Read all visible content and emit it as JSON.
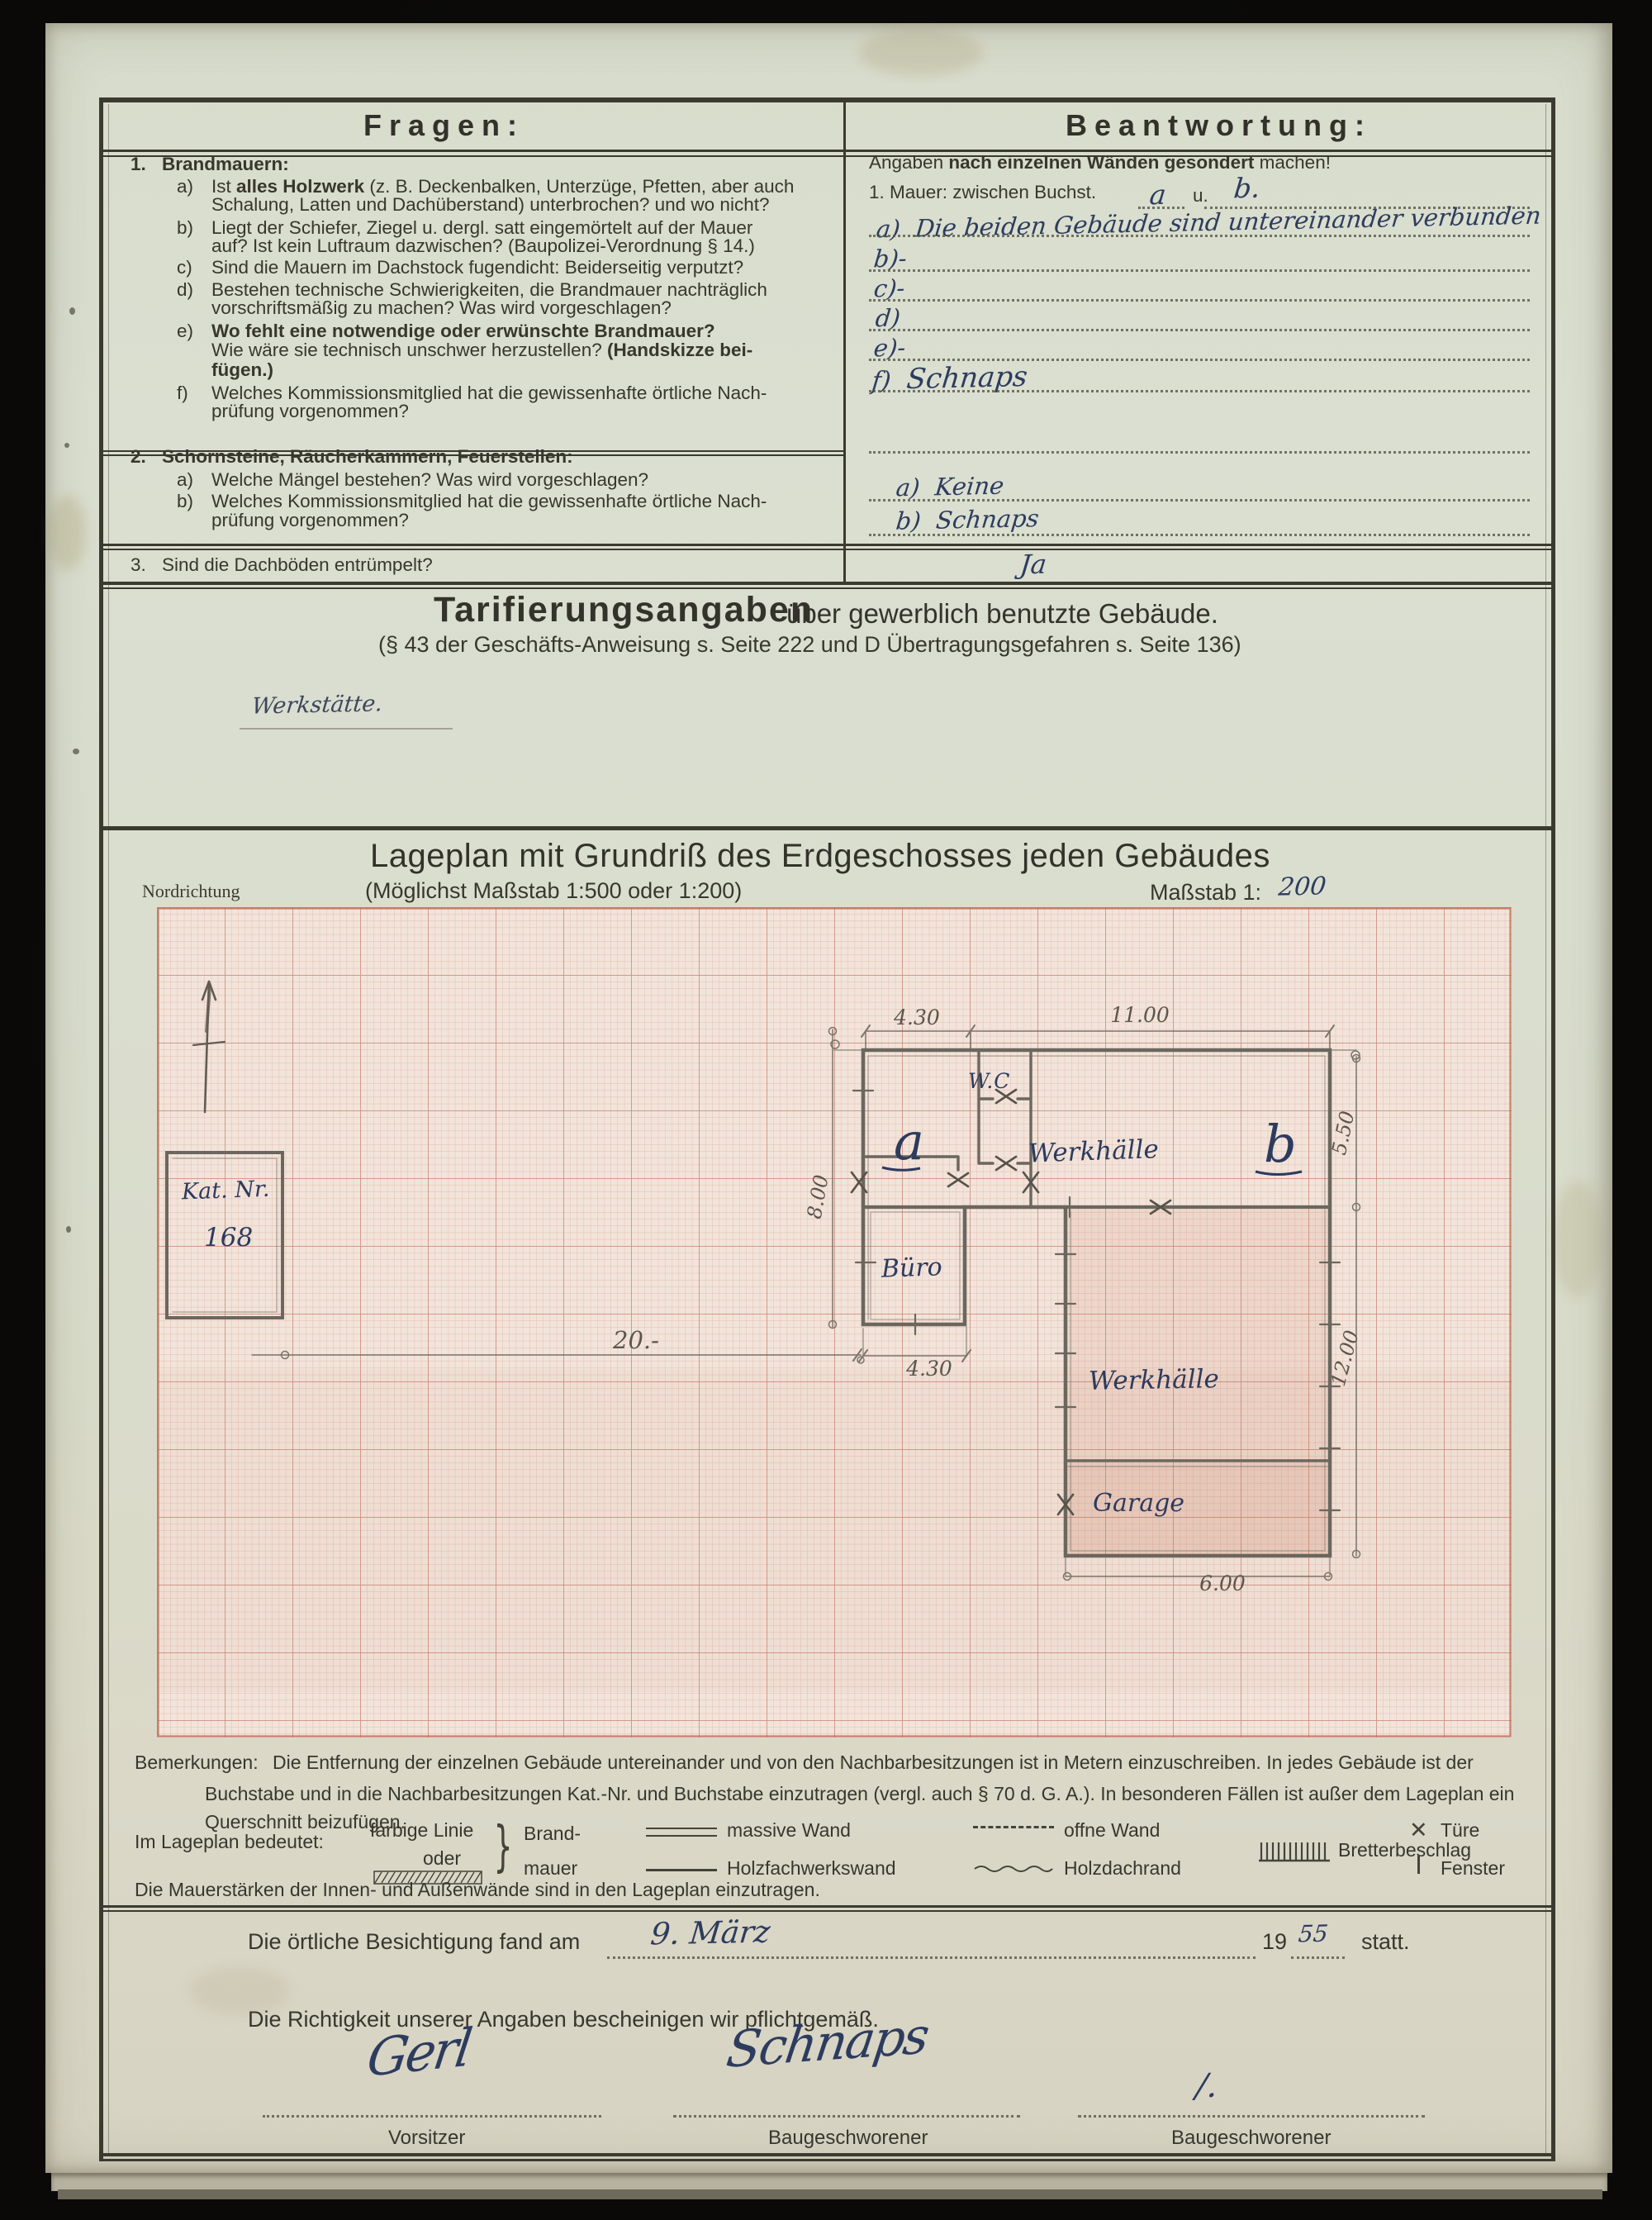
{
  "header": {
    "left": "Fragen:",
    "right": "Beantwortung:"
  },
  "q1": {
    "no": "1.",
    "title": "Brandmauern:",
    "a_letter": "a)",
    "a1_pre": "Ist ",
    "a1_b": "alles Holzwerk ",
    "a1_post": "(z. B. Deckenbalken, Unterzüge, Pfetten, aber auch",
    "a2": "Schalung, Latten und Dachüberstand) unterbrochen? und wo nicht?",
    "b_letter": "b)",
    "b1": "Liegt der Schiefer, Ziegel u. dergl. satt eingemörtelt auf der Mauer",
    "b2": "auf? Ist kein Luftraum dazwischen? (Baupolizei-Verordnung § 14.)",
    "c_letter": "c)",
    "c1": "Sind die Mauern im Dachstock fugendicht: Beiderseitig verputzt?",
    "d_letter": "d)",
    "d1": "Bestehen technische Schwierigkeiten, die Brandmauer nachträglich",
    "d2": "vorschriftsmäßig zu machen? Was wird vorgeschlagen?",
    "e_letter": "e)",
    "e1_b": "Wo fehlt eine notwendige oder erwünschte Brandmauer?",
    "e2": "Wie wäre sie technisch unschwer herzustellen? ",
    "e2_b": "(Handskizze bei-",
    "e3_b": "fügen.)",
    "f_letter": "f)",
    "f1": "Welches Kommissionsmitglied hat die gewissenhafte örtliche Nach-",
    "f2": "prüfung vorgenommen?"
  },
  "q2": {
    "no": "2.",
    "title": "Schornsteine, Räucherkammern, Feuerstellen:",
    "a_letter": "a)",
    "a1": "Welche Mängel bestehen? Was wird vorgeschlagen?",
    "b_letter": "b)",
    "b1": "Welches Kommissionsmitglied hat die gewissenhafte örtliche Nach-",
    "b2": "prüfung vorgenommen?"
  },
  "q3": {
    "no": "3.",
    "text": "Sind die Dachböden entrümpelt?"
  },
  "ans": {
    "intro_pre": "Angaben ",
    "intro_bold": "nach einzelnen Wänden gesondert",
    "intro_post": " machen!",
    "mauer_line": "1. Mauer: zwischen Buchst.",
    "mauer_a": "a",
    "mauer_u": "u.",
    "mauer_b": "b.",
    "a_label": "a)",
    "a_text": "Die beiden Gebäude sind untereinander verbunden",
    "b_label": "b)-",
    "c_label": "c)-",
    "d_label": "d)",
    "e_label": "e)-",
    "f_label": "f)",
    "f_text": "Schnaps",
    "s2a_label": "a)",
    "s2a_text": "Keine",
    "s2b_label": "b)",
    "s2b_text": "Schnaps",
    "s3_text": "Ja"
  },
  "tarif": {
    "title": "Tarifierungsangaben",
    "title_rest": "über gewerblich benutzte Gebäude.",
    "subtitle": "(§ 43 der Geschäfts-Anweisung s. Seite 222 und D Übertragungsgefahren s. Seite 136)",
    "note_hw": "Werkstätte."
  },
  "plan": {
    "heading": "Lageplan mit Grundriß des Erdgeschosses jeden Gebäudes",
    "subheading": "(Möglichst Maßstab 1:500 oder 1:200)",
    "north": "Nordrichtung",
    "scale_label": "Maßstab 1:",
    "scale_value": "200",
    "kat_line1": "Kat. Nr.",
    "kat_line2": "168",
    "room_a": "a",
    "room_b": "b",
    "wc": "W.C",
    "hall_b": "Werkhälle",
    "buero": "Büro",
    "werkhalle": "Werkhälle",
    "garage": "Garage",
    "dim_430_top": "4.30",
    "dim_1100": "11.00",
    "dim_550": "5.50",
    "dim_800": "8.00",
    "dim_430_buero": "4.30",
    "dim_20": "20.-",
    "dim_1200": "12.00",
    "dim_600": "6.00"
  },
  "bem": {
    "label": "Bemerkungen:",
    "line1": "Die Entfernung der einzelnen Gebäude untereinander und von den Nachbarbesitzungen ist in Metern einzuschreiben.  In jedes Gebäude ist der",
    "line2": "Buchstabe und in die Nachbarbesitzungen Kat.-Nr. und Buchstabe einzutragen (vergl. auch § 70 d. G. A.). In besonderen Fällen ist außer dem Lageplan ein",
    "line3": "Querschnitt beizufügen."
  },
  "legend": {
    "intro": "Im Lageplan bedeutet:",
    "farbige1": "farbige Linie",
    "farbige2": "oder",
    "brand1": "Brand-",
    "brand2": "mauer",
    "massiv": "massive Wand",
    "holzfachwerk": "Holzfachwerkswand",
    "offne": "offne Wand",
    "holzdach": "Holzdachrand",
    "bretter": "Bretterbeschlag",
    "tuere": "Türe",
    "fenster": "Fenster",
    "mauerstaerken": "Die Mauerstärken der Innen- und Außenwände sind in den Lageplan einzutragen."
  },
  "footer": {
    "besichtigung_pre": "Die örtliche Besichtigung fand am",
    "date_hw": "9. März",
    "year": "19",
    "year_hw": "55",
    "statt": "statt.",
    "richtigkeit": "Die Richtigkeit unserer Angaben bescheinigen wir pflichtgemäß.",
    "sig1": "Gerl",
    "sig1_label": "Vorsitzer",
    "sig2": "Schnaps",
    "sig2_label": "Baugeschworener",
    "sig3": "/.",
    "sig3_label": "Baugeschworener"
  }
}
